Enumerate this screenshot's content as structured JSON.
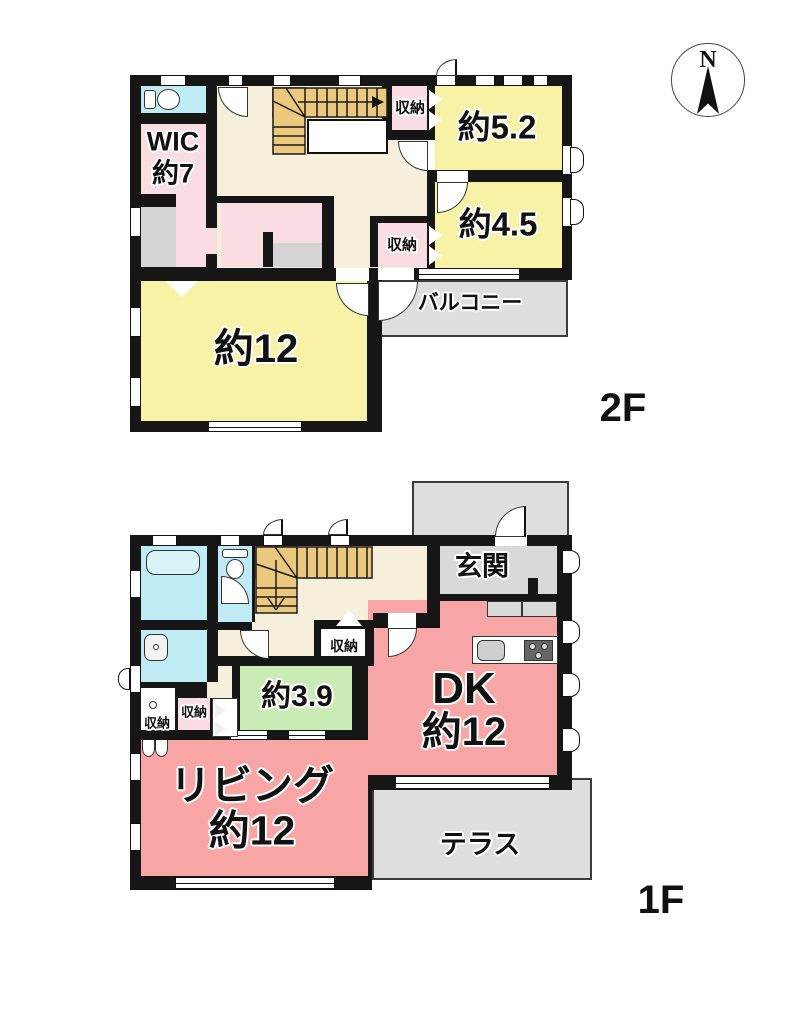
{
  "compass": {
    "north": "N"
  },
  "floor2": {
    "name": "2F",
    "wic1": "WIC",
    "wic2": "約7",
    "room52": "約5.2",
    "room45": "約4.5",
    "room12": "約12",
    "storage_top": "収納",
    "storage_mid": "収納",
    "balcony": "バルコニー"
  },
  "floor1": {
    "name": "1F",
    "entrance": "玄関",
    "dk1": "DK",
    "dk2": "約12",
    "room39": "約3.9",
    "living1": "リビング",
    "living2": "約12",
    "storage_hall": "収納",
    "storage_mid": "収納",
    "storage_closet": "収納",
    "terrace": "テラス"
  },
  "colors": {
    "wall": "#161616",
    "room_yellow": "#F7F2A5",
    "room_pink_light": "#FADDE3",
    "room_salmon": "#F8A5A5",
    "room_cyan": "#BEEBF4",
    "room_green": "#C9ECB7",
    "hall_cream": "#F5EFDB",
    "stairs_tan": "#EAC97E",
    "gray_area": "#DEDEDE",
    "gray_floor": "#D9D9D9",
    "gray_closet": "#D4D4D4"
  }
}
